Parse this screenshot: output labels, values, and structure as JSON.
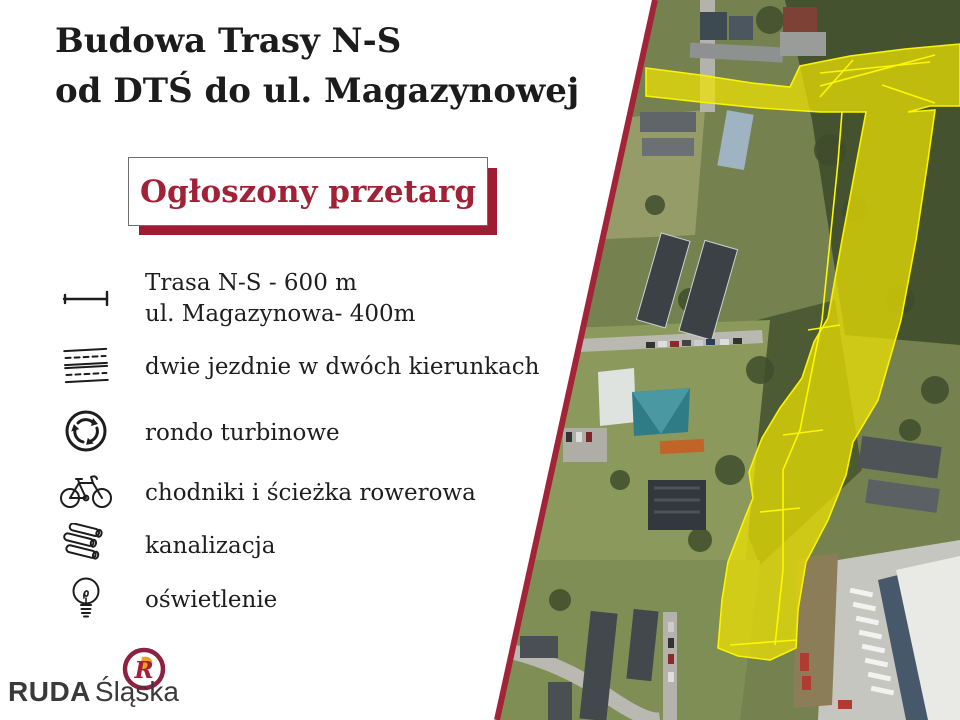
{
  "title": {
    "line1": "Budowa Trasy N-S",
    "line2": "od DTŚ do ul. Magazynowej"
  },
  "banner": {
    "label": "Ogłoszony przetarg"
  },
  "features": [
    {
      "icon": "distance-icon",
      "lines": [
        "Trasa N-S - 600 m",
        "ul. Magazynowa- 400m"
      ]
    },
    {
      "icon": "road-lanes-icon",
      "lines": [
        "dwie jezdnie w dwóch kierunkach"
      ]
    },
    {
      "icon": "roundabout-icon",
      "lines": [
        "rondo turbinowe"
      ]
    },
    {
      "icon": "bicycle-icon",
      "lines": [
        "chodniki i ścieżka rowerowa"
      ]
    },
    {
      "icon": "pipes-icon",
      "lines": [
        "kanalizacja"
      ]
    },
    {
      "icon": "lightbulb-icon",
      "lines": [
        "oświetlenie"
      ]
    }
  ],
  "logo": {
    "name_bold": "RUDA",
    "name_regular": "Śląska"
  },
  "map": {
    "kind": "satellite-aerial-photo",
    "overlay": "planned N-S route corridor highlighted in yellow",
    "highlight_color": "#f0e400"
  },
  "colors": {
    "accent_crimson": "#a22136",
    "divider": "#a32438",
    "title_text": "#1c1c1c",
    "logo_ring": "#8e2142",
    "logo_flame": "#f0a11a",
    "route_yellow": "#f0e400"
  }
}
